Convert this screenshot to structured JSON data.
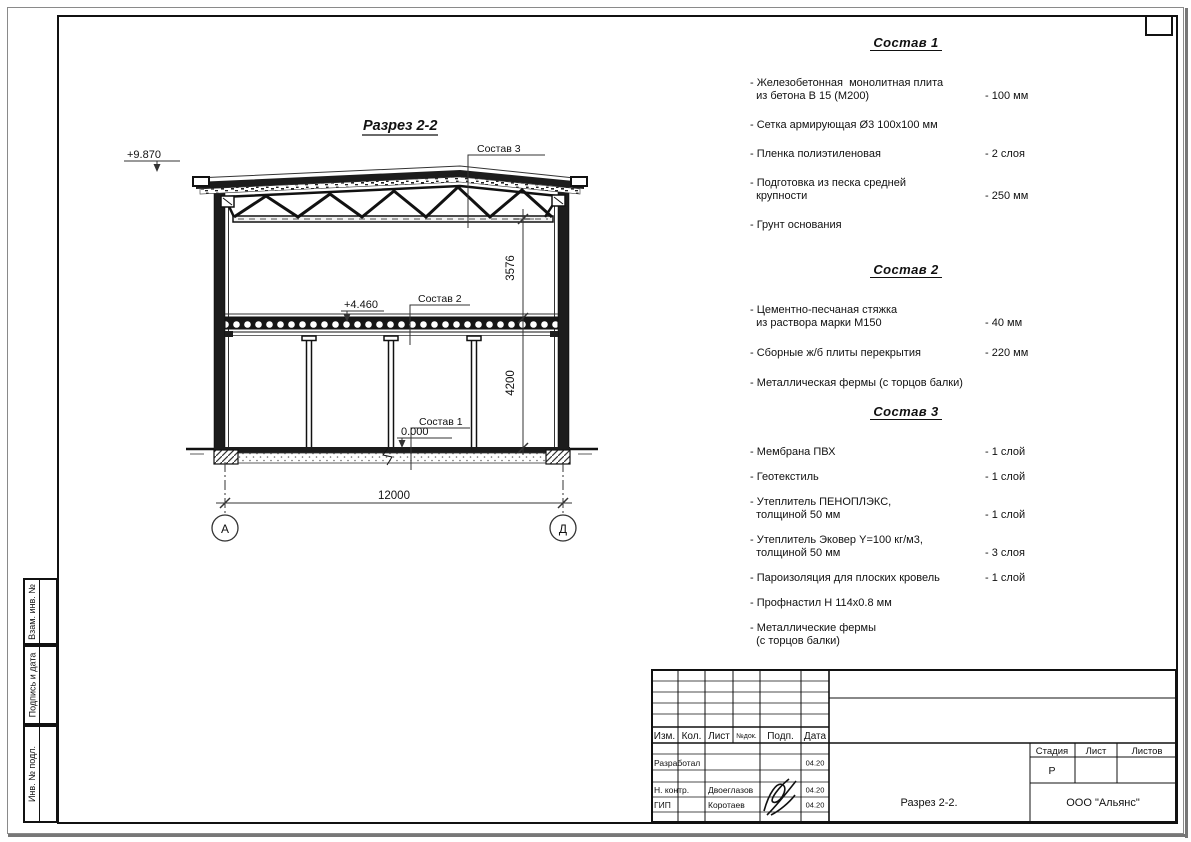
{
  "drawing": {
    "title": "Разрез 2-2",
    "elevation_roof": "+9.870",
    "elevation_floor2": "+4.460",
    "elevation_zero": "0.000",
    "callout_sostav3": "Состав 3",
    "callout_sostav2": "Состав 2",
    "callout_sostav1": "Состав 1",
    "dim_span": "12000",
    "dim_truss_height": "3576",
    "dim_floor_height": "4200",
    "axis_left": "А",
    "axis_right": "Д"
  },
  "compositions": [
    {
      "title": "Состав 1",
      "items": [
        {
          "name": "- Железобетонная  монолитная плита\n  из бетона В 15 (М200)",
          "value": "- 100 мм"
        },
        {
          "name": "- Сетка армирующая Ø3 100х100 мм",
          "value": ""
        },
        {
          "name": "- Пленка полиэтиленовая",
          "value": "-  2 слоя"
        },
        {
          "name": "- Подготовка из песка средней\n  крупности",
          "value": "- 250 мм"
        },
        {
          "name": "- Грунт основания",
          "value": ""
        }
      ]
    },
    {
      "title": "Состав 2",
      "items": [
        {
          "name": "- Цементно-песчаная стяжка\n  из раствора марки М150",
          "value": "- 40 мм"
        },
        {
          "name": "- Сборные ж/б плиты перекрытия",
          "value": "- 220 мм"
        },
        {
          "name": "- Металлическая фермы (с торцов балки)",
          "value": ""
        }
      ]
    },
    {
      "title": "Состав 3",
      "items": [
        {
          "name": "- Мембрана ПВХ",
          "value": "- 1 слой"
        },
        {
          "name": "- Геотекстиль",
          "value": "- 1 слой"
        },
        {
          "name": "- Утеплитель ПЕНОПЛЭКС,\n  толщиной 50 мм",
          "value": "- 1 слой"
        },
        {
          "name": "- Утеплитель Эковер Y=100 кг/м3,\n  толщиной 50 мм",
          "value": "- 3 слоя"
        },
        {
          "name": "- Пароизоляция для плоских кровель",
          "value": "- 1 слой"
        },
        {
          "name": "- Профнастил Н 114х0.8 мм",
          "value": ""
        },
        {
          "name": "- Металлические фермы\n  (с торцов балки)",
          "value": ""
        }
      ]
    }
  ],
  "side_strip": {
    "cell1": "Взам. инв. №",
    "cell2": "Подпись и дата",
    "cell3": "Инв. № подл."
  },
  "title_block": {
    "col_izm": "Изм.",
    "col_kol": "Кол.",
    "col_list": "Лист",
    "col_ndok": "№док.",
    "col_podp": "Подп.",
    "col_data": "Дата",
    "row1_role": "Разработал",
    "row1_date": "04.20",
    "row2_role": "Н. контр.",
    "row2_name": "Двоеглазов",
    "row2_date": "04.20",
    "row3_role": "ГИП",
    "row3_name": "Коротаев",
    "row3_date": "04.20",
    "doc_title": "Разрез 2-2.",
    "stage_label": "Стадия",
    "sheet_label": "Лист",
    "sheets_label": "Листов",
    "stage_value": "Р",
    "company": "ООО \"Альянс\""
  }
}
